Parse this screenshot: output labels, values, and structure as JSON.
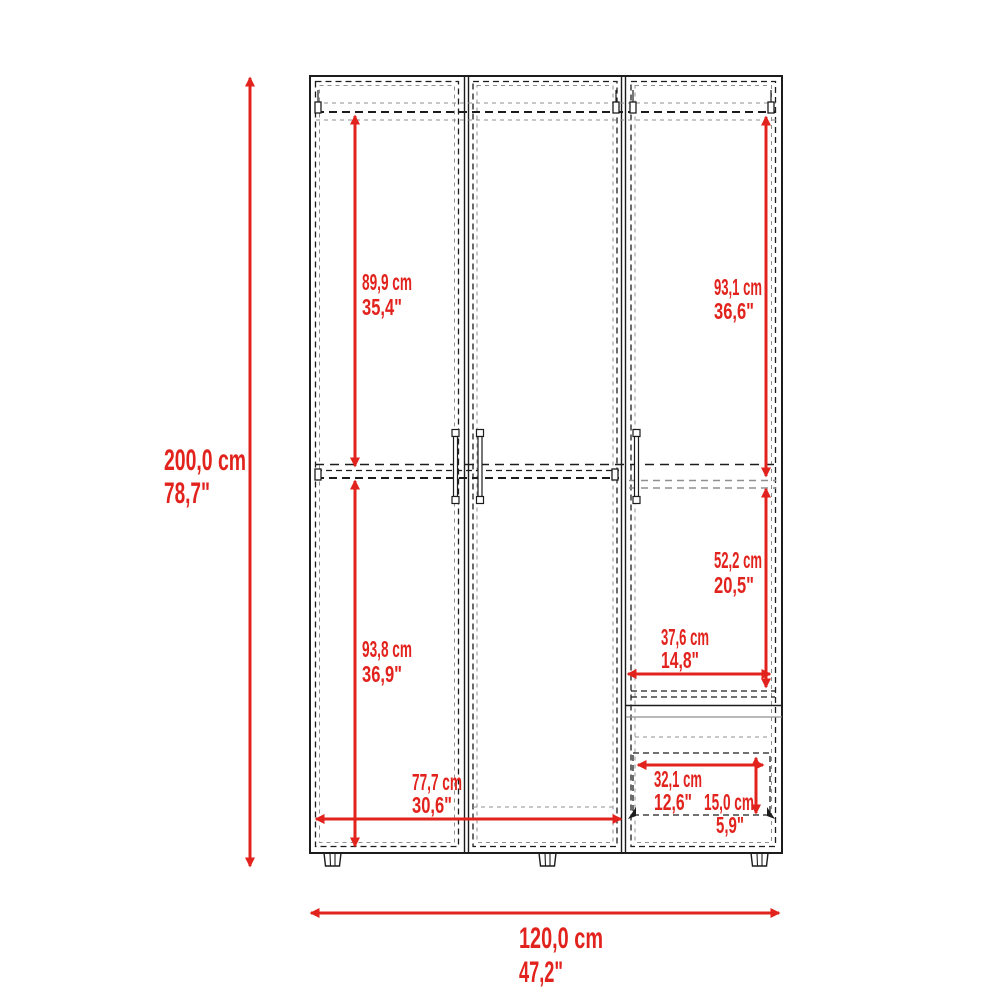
{
  "diagram": {
    "kind": "furniture-dimension-drawing",
    "subject": "three-door wardrobe front elevation with hanging rods and drawers",
    "colors": {
      "dimension_red": "#e2231d",
      "outline_dark": "#1c1c1c",
      "outline_gray": "#8f8f8f",
      "background": "#ffffff"
    },
    "overall": {
      "height": {
        "cm": "200,0 cm",
        "in": "78,7\""
      },
      "width": {
        "cm": "120,0 cm",
        "in": "47,2\""
      }
    },
    "dims": {
      "left_upper_height": {
        "cm": "89,9 cm",
        "in": "35,4\""
      },
      "left_lower_height": {
        "cm": "93,8 cm",
        "in": "36,9\""
      },
      "right_upper_height": {
        "cm": "93,1 cm",
        "in": "36,6\""
      },
      "right_middle_height": {
        "cm": "52,2 cm",
        "in": "20,5\""
      },
      "right_shelf_width": {
        "cm": "37,6 cm",
        "in": "14,8\""
      },
      "bottom_opening_width": {
        "cm": "77,7 cm",
        "in": "30,6\""
      },
      "drawer_width": {
        "cm": "32,1 cm",
        "in": "12,6\""
      },
      "drawer_height": {
        "cm": "15,0 cm",
        "in": "5,9\""
      }
    }
  }
}
